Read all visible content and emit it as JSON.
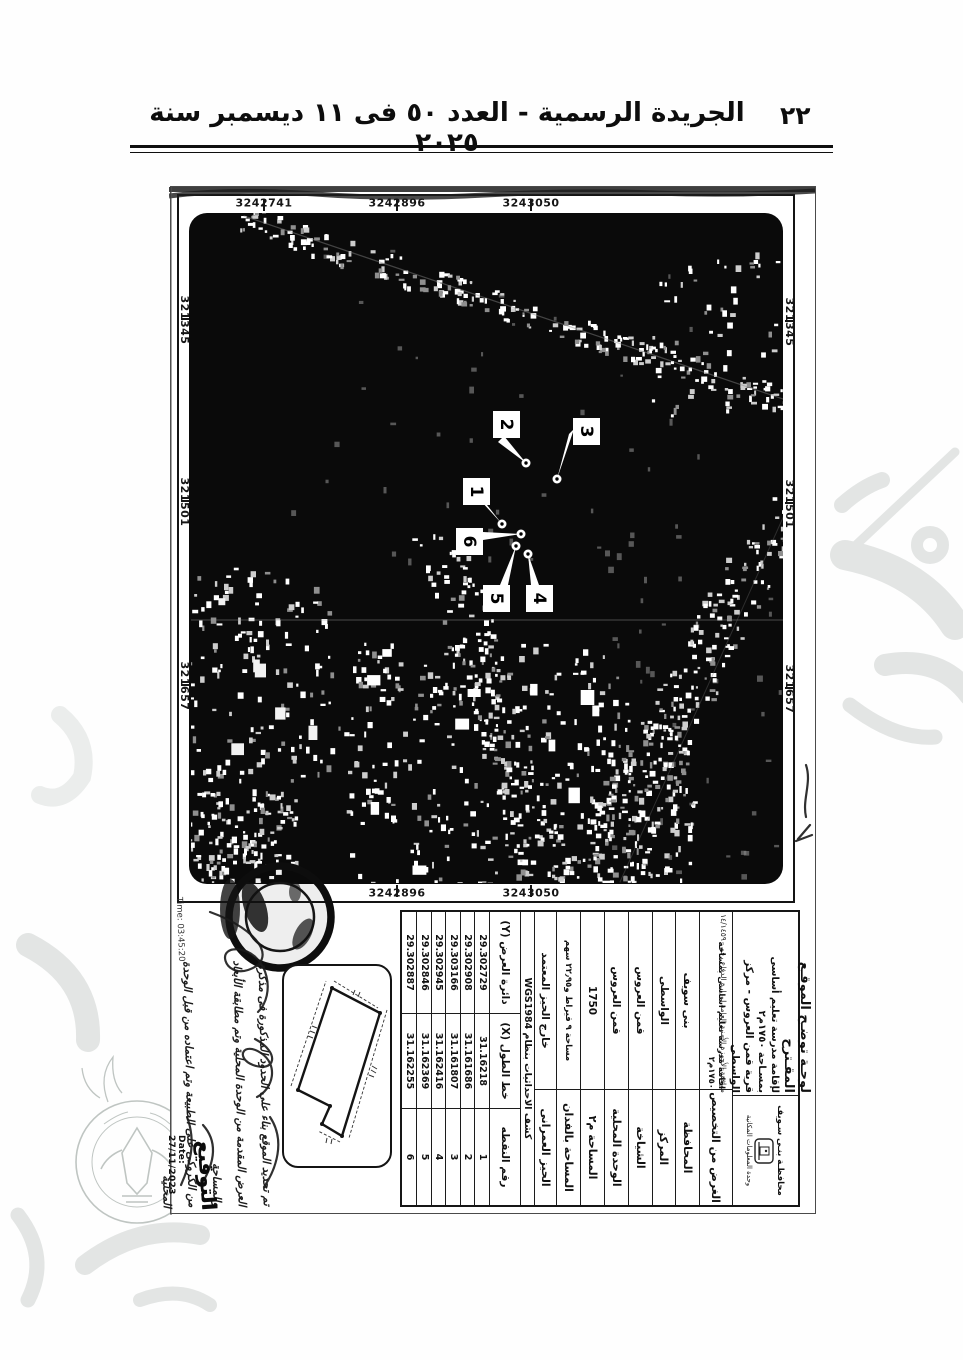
{
  "header": {
    "page_number": "٢٢",
    "title": "الجريدة الرسمية - العدد ٥٠ فى ١١ ديسمبر سنة ٢٠٢٥"
  },
  "map": {
    "grid": {
      "northing_labels": [
        "3242741",
        "3242896",
        "3243050"
      ],
      "northing_labels_right": [
        "3242896",
        "3243050"
      ],
      "easting_labels": [
        "321345",
        "321501",
        "321657"
      ]
    },
    "markers": [
      {
        "id": "1"
      },
      {
        "id": "2"
      },
      {
        "id": "3"
      },
      {
        "id": "4"
      },
      {
        "id": "5"
      },
      {
        "id": "6"
      }
    ]
  },
  "titleblock": {
    "line1": "لوحـة توضـح الموقـع المقـترح",
    "line2": "لإقامة مدرسة تعليم أساسى بمسـاحة ١٧٥٠م٢",
    "line3": "قرية قمن العروس - مركز الواسطى",
    "line4": "موافقة الأجهزة الأمنية العامة لوزارة الدفاع رقم ١٤/١٤٥٩٠",
    "gov_line1": "محافظـة بنـى سـويف",
    "gov_line2": "وحدة المعلومات المكانية"
  },
  "table": {
    "rows": [
      {
        "label": "الغرض من التخصيص",
        "value": "اقامة مدرسة تعليم اساسى بمساحة ١٧٥٠م٢"
      },
      {
        "label": "المحافظة",
        "value": "بنى سويف"
      },
      {
        "label": "المركز",
        "value": "الواسطى"
      },
      {
        "label": "الشياخة",
        "value": "قمن العروس"
      },
      {
        "label": "الوحدة المحلية",
        "value": "قمن العروس"
      },
      {
        "label": "المساحة م٢",
        "value": "1750"
      },
      {
        "label": "المساحة بالفدان",
        "value": "مساحة ٩ قيراط و٢٢٫٩٥ سهم"
      },
      {
        "label": "الحيز العمرانى",
        "value": "خارج الحيز المعتمد"
      }
    ],
    "wgs_header": "كشف الاحداثيات بنظام WGS1984",
    "coord_headers": {
      "point": "رقم النقطه",
      "x": "خط الطول (X)",
      "y": "دائرة العرض (Y)"
    },
    "points": [
      {
        "no": "1",
        "x": "31.16218",
        "y": "29.302729"
      },
      {
        "no": "2",
        "x": "31.161686",
        "y": "29.302908"
      },
      {
        "no": "3",
        "x": "31.161807",
        "y": "29.303166"
      },
      {
        "no": "4",
        "x": "31.162416",
        "y": "29.302945"
      },
      {
        "no": "5",
        "x": "31.162369",
        "y": "29.302846"
      },
      {
        "no": "6",
        "x": "31.162255",
        "y": "29.302887"
      }
    ]
  },
  "annotations": {
    "note_line1": "تم تحديد الموقع بناء على الحدود المذكورة فى مذكرة",
    "note_line2": "العرض المقدمة من الوحدة المحلية وتم مطابقة الأبعاد والمساحة",
    "note_line3": "من الكروكى على الطبيعة وتم اعتماده من قبل الوحدة المحلية",
    "signature_label": "التوقيع",
    "date": "Date: 27/11/2023",
    "time": "Time: 03:45:20"
  }
}
